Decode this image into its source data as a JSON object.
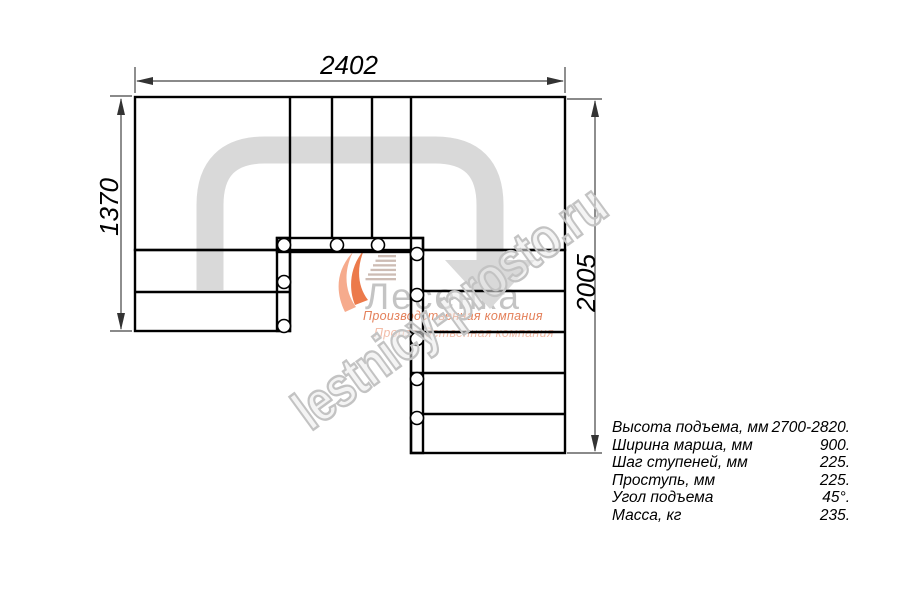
{
  "drawing": {
    "type": "staircase-floor-plan",
    "dimensions": {
      "top_width_mm": "2402",
      "left_height_mm": "1370",
      "right_height_mm": "2005"
    }
  },
  "specs": {
    "rows": [
      {
        "label": "Высота подъема, мм",
        "value": "2700-2820."
      },
      {
        "label": "Ширина марша, мм",
        "value": "900."
      },
      {
        "label": "Шаг ступеней, мм",
        "value": "225."
      },
      {
        "label": "Проступь, мм",
        "value": "225."
      },
      {
        "label": "Угол подъема",
        "value": "45°."
      },
      {
        "label": "Масса, кг",
        "value": "235."
      }
    ]
  },
  "watermark": {
    "text": "lestnicy-prosto.ru"
  },
  "logo": {
    "name": "Лесенка",
    "caption_primary": "Производственная компания",
    "caption_secondary": "Производственная компания"
  },
  "colors": {
    "line": "#000000",
    "direction_arrow": "#d9d9d9",
    "watermark": "#c3c3c3",
    "logo_orange": "#ec7a4b",
    "logo_orange_light": "#f5ab8e"
  }
}
